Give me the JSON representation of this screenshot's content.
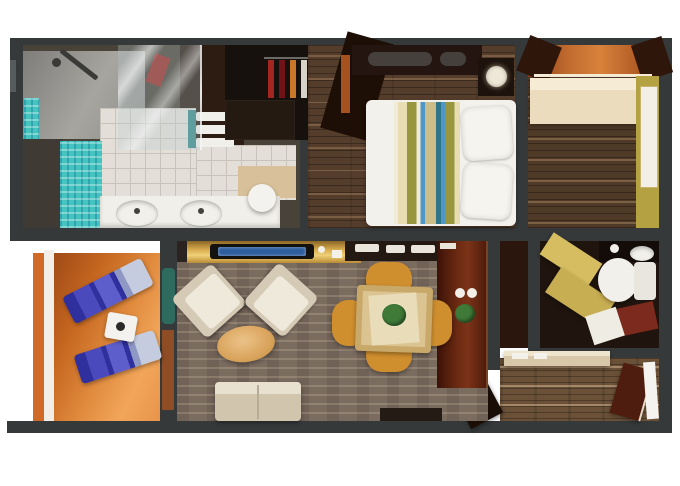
{
  "meta": {
    "title": "Suite floor plan",
    "type": "3D top-down floor plan render, no visible text",
    "canvas": {
      "width": 680,
      "height": 486
    }
  },
  "rooms": [
    {
      "name": "master-bathroom",
      "position": "top-left",
      "features": [
        "walk-in shower",
        "glass partition",
        "aqua mosaic panels",
        "double-sink vanity",
        "towel shelf",
        "round stool"
      ]
    },
    {
      "name": "walk-in-closet",
      "position": "top-center",
      "features": [
        "hanging clothes",
        "drawer unit"
      ]
    },
    {
      "name": "bedroom",
      "position": "top-center-right",
      "features": [
        "double bed with striped patchwork duvet",
        "two white pillows",
        "dark headboard with bolsters",
        "nightstand with lamp"
      ]
    },
    {
      "name": "entry-foyer",
      "position": "top-right",
      "features": [
        "cream credenza",
        "mirror",
        "yellow accent wall",
        "warm ceiling band"
      ]
    },
    {
      "name": "guest-bathroom",
      "position": "right",
      "features": [
        "toilet",
        "washbasin",
        "gold sliding door",
        "maroon and white bath mats"
      ]
    },
    {
      "name": "entry-corridor",
      "position": "bottom-right",
      "features": [
        "console table with papers",
        "entry door"
      ]
    },
    {
      "name": "living-dining-room",
      "position": "center",
      "features": [
        "gold TV console",
        "two beige armchairs",
        "oval ottoman",
        "beige sofa",
        "square dining table with four gold chairs",
        "dark bar cabinet with cups and plant",
        "potted plant"
      ]
    },
    {
      "name": "balcony",
      "position": "bottom-left",
      "features": [
        "two blue sun loungers",
        "white side table",
        "railing"
      ]
    }
  ],
  "palette": {
    "wall": "#35393a",
    "wallNotch": "#565b5c",
    "background": "#ffffff",
    "bathBase": "#494239",
    "showerArm": "#3a3a38",
    "vanityDark": "#2c1c12",
    "towelWhite": "#f1efe9",
    "tealEdge": "#3a8a8a",
    "bathSideDark": "#3f3a33",
    "tanFloor": "#d8c09a",
    "counterWhite": "#f1efe9",
    "fixtureWhite": "#f2f0eb",
    "sinkDot": "#44403a",
    "stoolWhite": "#f4f2ee",
    "closetDark": "#17110d",
    "closetDrawers": "#241a12",
    "railGray": "#6a6a66",
    "clothes1": "#a32622",
    "clothes2": "#701218",
    "clothes3": "#c87828",
    "clothes4": "#d6d2c8",
    "clothes5": "#8a4a20",
    "clothes6": "#b03c20",
    "angledWood": "#1d0e06",
    "headboard": "#241510",
    "bolsterGray": "#45403c",
    "curtainOrange": "#a5521f",
    "bedWhite": "#f3f1ec",
    "pillowWhite": "#f6f4ef",
    "nightstand": "#1d120c",
    "lampShade": "#efe8d8",
    "beamDark": "#2f160b",
    "credenza": "#ecdcbe",
    "credenzaTop": "#f6ecd6",
    "yellowWall": "#b3a142",
    "mirrorWhite": "#f2efe6",
    "bath2Floor": "#20150e",
    "goldDoor": "#d6bd62",
    "goldDoor2": "#c8ae52",
    "bath2Counter": "#130c08",
    "cupWhite": "#f2efe8",
    "tankWhite": "#e9e6df",
    "maroonMat": "#7c2a1d",
    "whiteMat": "#efece4",
    "builtInWood": "#2a160c",
    "consoleBeige": "#d8c7a9",
    "consoleTop": "#efe4cc",
    "paperWhite": "#f4f1ea",
    "entryDoorDark": "#4f1d10",
    "entryDoorWhite": "#f5f3ef",
    "openDoorLeaf": "#1a0d06",
    "livingTopSliver": "#2a2320",
    "tvBody": "#14120f",
    "tvScreenBlue": "#2e5d9e",
    "sideboardDark": "#241812",
    "trayWhite": "#e9e5db",
    "plantGreen": "#3f7a38",
    "plantTeal": "#2e6b5e",
    "armchairBeige": "#d5cab5",
    "seatHighlight": "#efe9db",
    "sofaBeige": "#d2c5ad",
    "sofaTopLight": "#e9e1cf",
    "sofaSeam": "#b8ac96",
    "darkFurniture": "#241c14",
    "tableWood": "#c9a96a",
    "tableInner": "#dcc392",
    "tableRunner": "#e9dcb8",
    "diningChairGold": "#d08f2e",
    "railOrange": "#cf6a28",
    "railWhite": "#f3efe8",
    "loungerBase": "#2f2f9e",
    "loungerLight": "#5d5dcb",
    "loungerPad": "#c6ccdf",
    "sideTableWhite": "#f4f2ee",
    "kettleDark": "#2a2a2a"
  }
}
